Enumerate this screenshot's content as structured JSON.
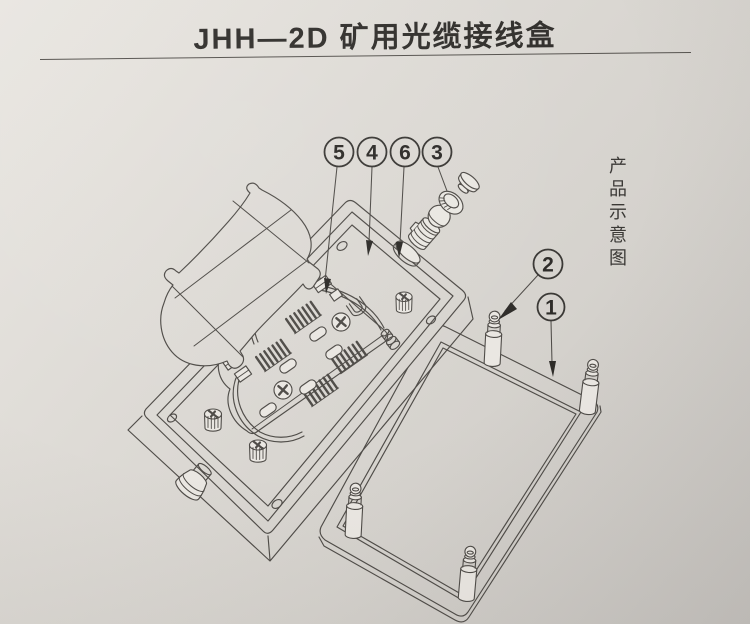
{
  "page": {
    "title": "JHH—2D 矿用光缆接线盒",
    "side_caption": "产品示意图"
  },
  "callouts": {
    "top": [
      {
        "label": "5"
      },
      {
        "label": "4"
      },
      {
        "label": "6"
      },
      {
        "label": "3"
      }
    ],
    "right": [
      {
        "label": "2"
      },
      {
        "label": "1"
      }
    ]
  },
  "colors": {
    "paper_light": "#eae7e2",
    "paper_dark": "#c6c3bf",
    "line_ink": "#4f4c48",
    "text_ink": "#32302d"
  }
}
